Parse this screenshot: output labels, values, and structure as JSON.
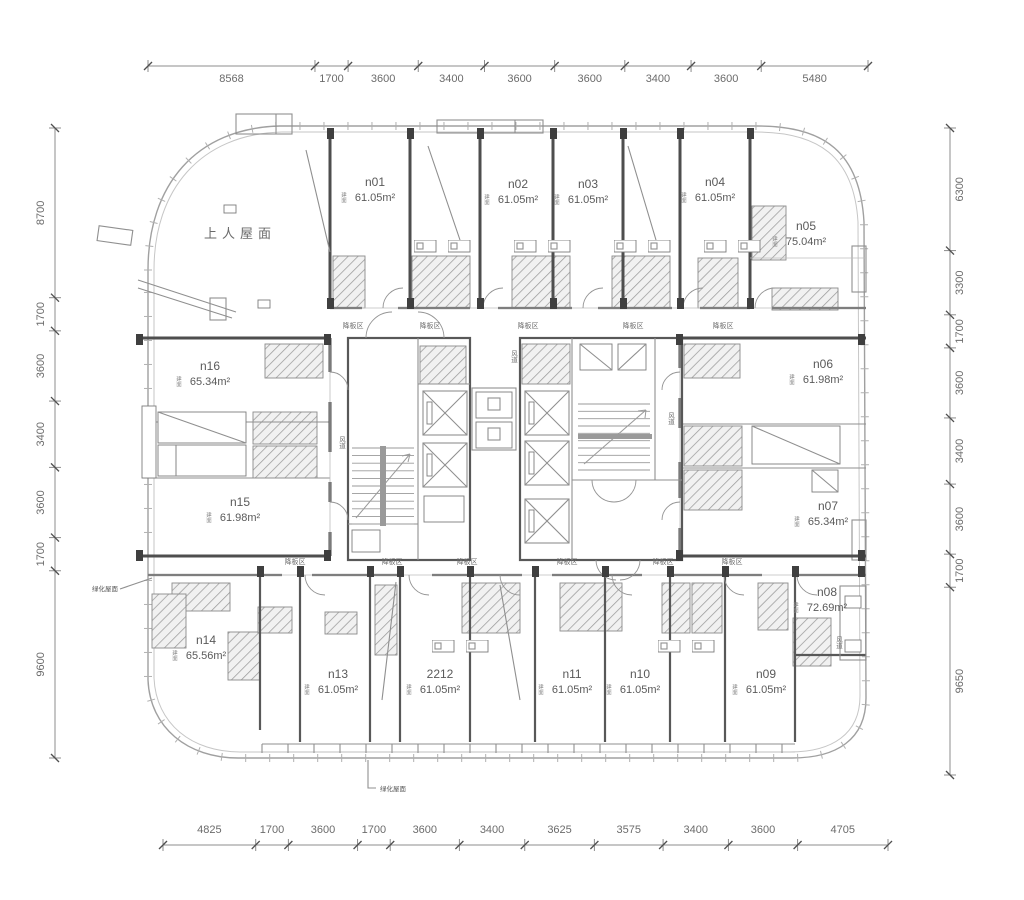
{
  "drawing": {
    "roof_label": "上人屋面",
    "sunken_zone_label": "降板区",
    "air_duct_label": "风道",
    "area_prefix": "建面",
    "note_left": "绿化屋面",
    "note_bottom": "绿化屋面"
  },
  "units": [
    {
      "id": "n01",
      "area": "61.05m²"
    },
    {
      "id": "n02",
      "area": "61.05m²"
    },
    {
      "id": "n03",
      "area": "61.05m²"
    },
    {
      "id": "n04",
      "area": "61.05m²"
    },
    {
      "id": "n05",
      "area": "75.04m²"
    },
    {
      "id": "n06",
      "area": "61.98m²"
    },
    {
      "id": "n07",
      "area": "65.34m²"
    },
    {
      "id": "n08",
      "area": "72.69m²"
    },
    {
      "id": "n09",
      "area": "61.05m²"
    },
    {
      "id": "n10",
      "area": "61.05m²"
    },
    {
      "id": "n11",
      "area": "61.05m²"
    },
    {
      "id": "2212",
      "area": "61.05m²"
    },
    {
      "id": "n13",
      "area": "61.05m²"
    },
    {
      "id": "n14",
      "area": "65.56m²"
    },
    {
      "id": "n15",
      "area": "61.98m²"
    },
    {
      "id": "n16",
      "area": "65.34m²"
    }
  ],
  "dimensions": {
    "top": [
      "8568",
      "1700",
      "3600",
      "3400",
      "3600",
      "3600",
      "3400",
      "3600",
      "5480"
    ],
    "bottom": [
      "4825",
      "1700",
      "3600",
      "1700",
      "3600",
      "3400",
      "3625",
      "3575",
      "3400",
      "3600",
      "4705"
    ],
    "left": [
      "8700",
      "1700",
      "3600",
      "3400",
      "3600",
      "1700",
      "9600"
    ],
    "right": [
      "6300",
      "3300",
      "1700",
      "3600",
      "3400",
      "3600",
      "1700",
      "9650"
    ]
  },
  "colors": {
    "wall": "#4e4e4e",
    "light_line": "#a8a8a8",
    "text": "#636363",
    "hatch": "#9b9b9b",
    "background": "#ffffff"
  }
}
